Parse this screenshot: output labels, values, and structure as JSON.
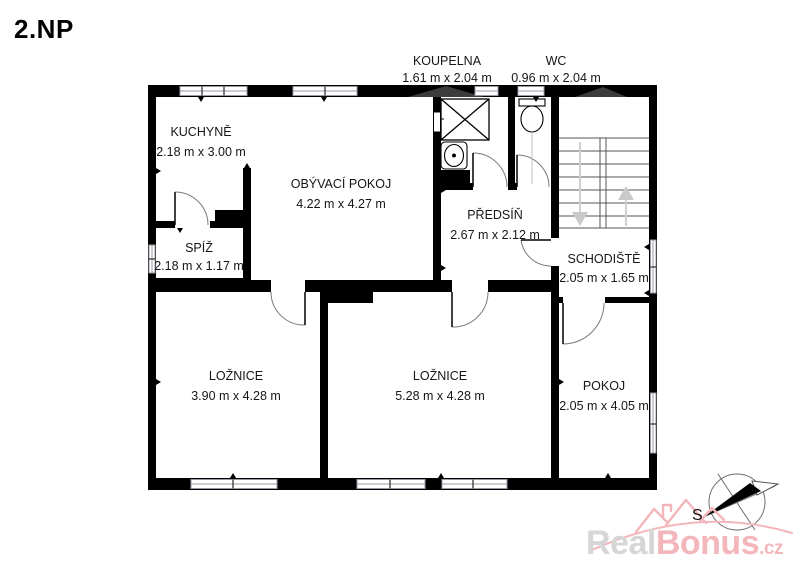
{
  "title": "2.NP",
  "rooms": [
    {
      "id": "kuchyne",
      "name": "KUCHYNĚ",
      "dims": "2.18 m x 3.00 m"
    },
    {
      "id": "obyvaci",
      "name": "OBÝVACÍ POKOJ",
      "dims": "4.22 m x 4.27 m"
    },
    {
      "id": "koupelna",
      "name": "KOUPELNA",
      "dims": "1.61 m x 2.04 m"
    },
    {
      "id": "wc",
      "name": "WC",
      "dims": "0.96 m x 2.04 m"
    },
    {
      "id": "predsin",
      "name": "PŘEDSÍŇ",
      "dims": "2.67 m x 2.12 m"
    },
    {
      "id": "spiz",
      "name": "SPÍŽ",
      "dims": "2.18 m x 1.17 m"
    },
    {
      "id": "schodiste",
      "name": "SCHODIŠTĚ",
      "dims": "2.05 m x 1.65 m"
    },
    {
      "id": "loznice1",
      "name": "LOŽNICE",
      "dims": "3.90 m x 4.28 m"
    },
    {
      "id": "loznice2",
      "name": "LOŽNICE",
      "dims": "5.28 m x 4.28 m"
    },
    {
      "id": "pokoj",
      "name": "POKOJ",
      "dims": "2.05 m x 4.05 m"
    }
  ],
  "compass": {
    "label": "S"
  },
  "watermark": {
    "real": "Real",
    "bonus": "Bonus",
    "tld": ".cz"
  },
  "colors": {
    "wall": "#000000",
    "logo_gray": "#d6d6d6",
    "logo_pink": "#f3b7bb",
    "stair_arrow": "#c9c9c9",
    "window_frame": "#9a9aa6"
  }
}
